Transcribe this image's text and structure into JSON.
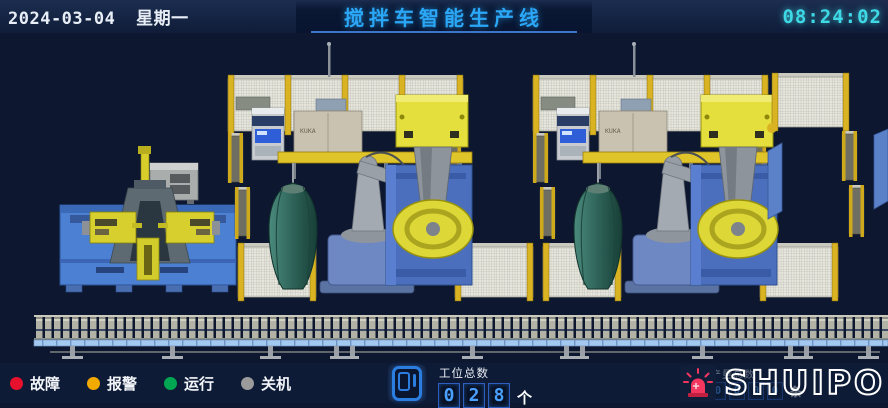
{
  "header": {
    "date": "2024-03-04",
    "weekday": "星期一",
    "title": "搅拌车智能生产线",
    "time": "08:24:02"
  },
  "colors": {
    "title_blue": "#2ba7f7",
    "time_cyan": "#3fd9e6",
    "accent_blue": "#2b7de0",
    "digit_blue": "#4aa0ff",
    "beacon_pink": "#f5365f",
    "fault_red": "#e8112d",
    "alarm_orange": "#f2a900",
    "run_green": "#00a651",
    "off_gray": "#9b9b9b"
  },
  "scene": {
    "kuka_label": "KUKA"
  },
  "footer": {
    "legend": [
      {
        "label": "故障",
        "color": "#e8112d"
      },
      {
        "label": "报警",
        "color": "#f2a900"
      },
      {
        "label": "运行",
        "color": "#00a651"
      },
      {
        "label": "关机",
        "color": "#9b9b9b"
      }
    ],
    "station_counter": {
      "label": "工位总数",
      "digits": [
        "0",
        "2",
        "8"
      ],
      "unit": "个"
    },
    "production_counter": {
      "label": "产量总数",
      "digits": [
        "0",
        "0",
        "0",
        "0"
      ],
      "unit": "条"
    },
    "logo": "SHUIPO"
  }
}
